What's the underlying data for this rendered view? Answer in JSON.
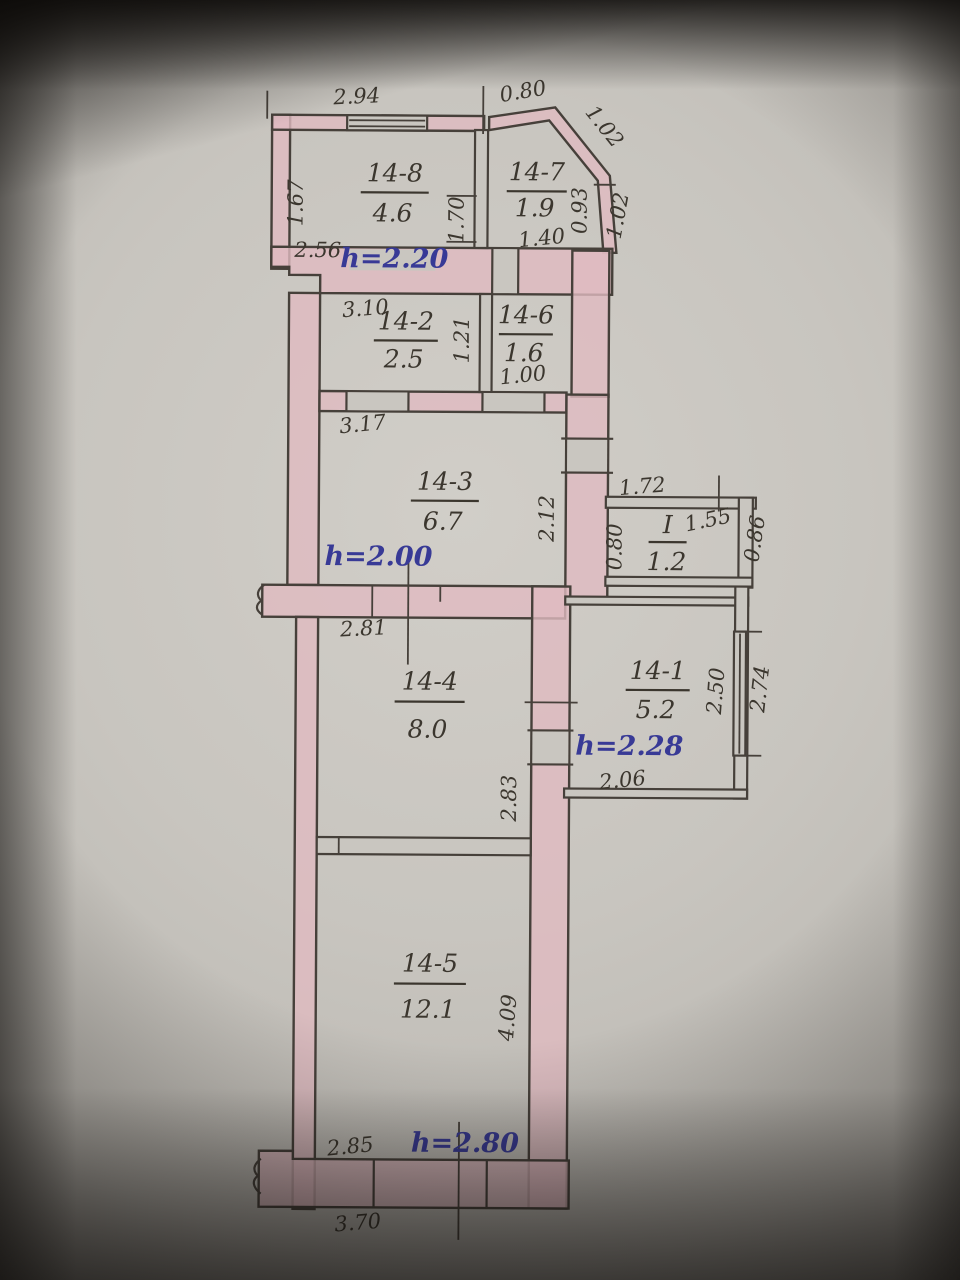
{
  "colors": {
    "paper": "#c8c5bf",
    "wall_highlight": "#e0bac1",
    "ink": "#46403a",
    "pencil_text": "#3b362e",
    "blue_ink": "#383a96"
  },
  "rooms": {
    "r14_8": {
      "number": "14-8",
      "area": "4.6"
    },
    "r14_7": {
      "number": "14-7",
      "area": "1.9"
    },
    "r14_2": {
      "number": "14-2",
      "area": "2.5"
    },
    "r14_6": {
      "number": "14-6",
      "area": "1.6"
    },
    "r14_3": {
      "number": "14-3",
      "area": "6.7"
    },
    "rI": {
      "number": "I",
      "area": "1.2"
    },
    "r14_1": {
      "number": "14-1",
      "area": "5.2"
    },
    "r14_4": {
      "number": "14-4",
      "area": "8.0"
    },
    "r14_5": {
      "number": "14-5",
      "area": "12.1"
    }
  },
  "heights": {
    "upper": "h=2.20",
    "middle": "h=2.00",
    "right": "h=2.28",
    "lower": "h=2.80"
  },
  "dims": {
    "balcony_width": "2.94",
    "bay_top": "0.80",
    "bay_diagonal": "1.02",
    "balcony_depth": "1.67",
    "balcony_inner_width": "2.56",
    "partition_14_8_14_7": "1.70",
    "bay_inner_height": "0.93",
    "bay_outer_height": "1.02",
    "room_14_7_bottom": "1.40",
    "room_14_2_width": "3.10",
    "room_14_2_height": "1.21",
    "room_14_6_bottom": "1.00",
    "room_14_3_width": "3.17",
    "room_14_3_height": "2.12",
    "storeroom_top": "1.72",
    "storeroom_inner": "1.55",
    "storeroom_left": "0.80",
    "storeroom_right": "0.86",
    "room_14_1_window": "2.50",
    "room_14_1_right": "2.74",
    "room_14_1_bottom": "2.06",
    "room_14_4_top": "2.81",
    "room_14_4_height": "2.83",
    "room_14_5_height": "4.09",
    "room_14_5_bottom": "2.85",
    "bottom_outer": "3.70"
  }
}
